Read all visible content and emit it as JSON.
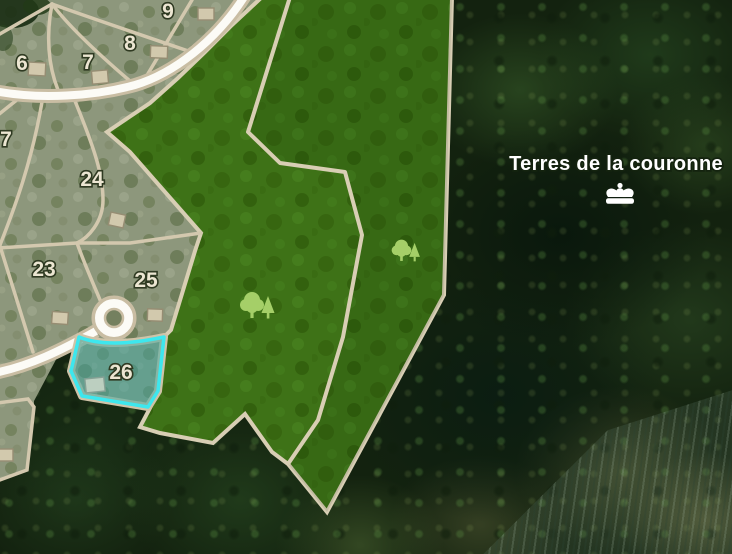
{
  "map": {
    "region_label": "Terres de la couronne",
    "parcels": [
      {
        "number": "6"
      },
      {
        "number": "7"
      },
      {
        "number": "8"
      },
      {
        "number": "9"
      },
      {
        "number": "7"
      },
      {
        "number": "24"
      },
      {
        "number": "23"
      },
      {
        "number": "25"
      },
      {
        "number": "26"
      }
    ],
    "selected_parcel": {
      "number": "26",
      "highlight_color": "#3de7ee"
    },
    "icons": {
      "forest": "tree-icon",
      "crown": "crown-icon",
      "building": "building-marker"
    },
    "colors": {
      "forest_zone_fill": "#3e7217",
      "parcel_fill": "#8d977c",
      "boundary_line": "#d3c8ae",
      "road_fill": "#fcfbf6",
      "highlight_stroke": "#3de7ee",
      "parcel_number_text": "#ece6d2",
      "region_label_text": "#ffffff"
    }
  }
}
